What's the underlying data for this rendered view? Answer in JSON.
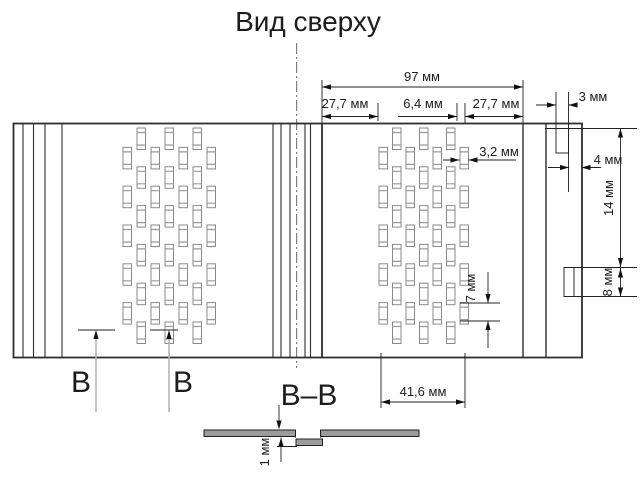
{
  "drawing": {
    "title": "Вид сверху",
    "section_label": "В–В",
    "section_marker": "В",
    "dims": {
      "overall_width": "97 мм",
      "margin": "27,7 мм",
      "slot_gap": "6,4 мм",
      "slot_width": "3,2 мм",
      "edge_offset": "3 мм",
      "tab_width": "4 мм",
      "tab1_length": "14 мм",
      "tab2_length": "8 мм",
      "slot_length": "7 мм",
      "field_width": "41,6 мм",
      "louver_drop": "1 мм"
    },
    "colors": {
      "line": "#2e2e2e",
      "metal_fill": "#9c9c9c"
    }
  }
}
